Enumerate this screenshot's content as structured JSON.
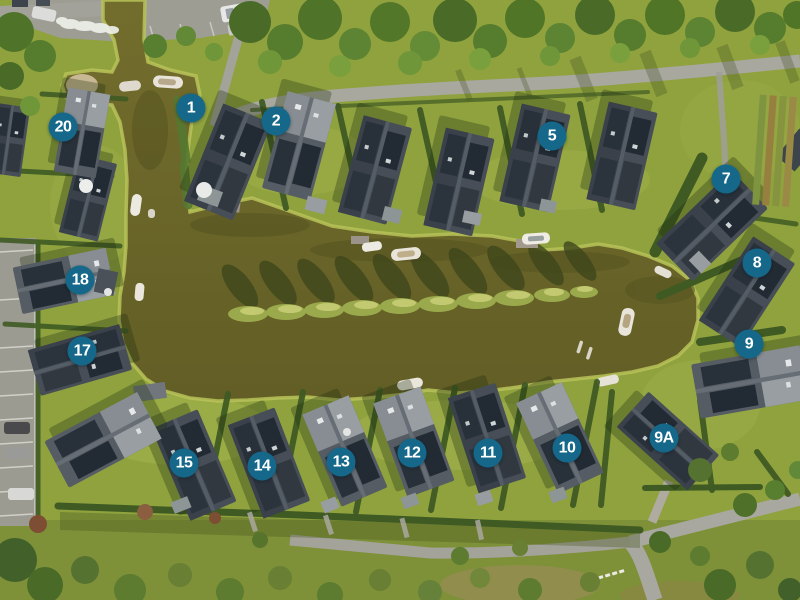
{
  "park_map": {
    "description": "aerial-photo-site-map-with-numbered-lots",
    "marker_color": "#15688a",
    "marker_text_color": "#ffffff",
    "markers": [
      {
        "label": "1",
        "x": 191,
        "y": 108
      },
      {
        "label": "2",
        "x": 276,
        "y": 121
      },
      {
        "label": "5",
        "x": 552,
        "y": 136
      },
      {
        "label": "7",
        "x": 726,
        "y": 179
      },
      {
        "label": "8",
        "x": 757,
        "y": 263
      },
      {
        "label": "9",
        "x": 749,
        "y": 344
      },
      {
        "label": "9A",
        "x": 664,
        "y": 438
      },
      {
        "label": "10",
        "x": 567,
        "y": 448
      },
      {
        "label": "11",
        "x": 488,
        "y": 453
      },
      {
        "label": "12",
        "x": 412,
        "y": 453
      },
      {
        "label": "13",
        "x": 341,
        "y": 462
      },
      {
        "label": "14",
        "x": 262,
        "y": 466
      },
      {
        "label": "15",
        "x": 184,
        "y": 463
      },
      {
        "label": "17",
        "x": 82,
        "y": 351
      },
      {
        "label": "18",
        "x": 80,
        "y": 280
      },
      {
        "label": "20",
        "x": 63,
        "y": 127
      }
    ],
    "colors": {
      "grass": "#8fa23e",
      "water": "#6e682a",
      "roof_dark": "#3c434b",
      "hedge": "#3f5a23",
      "road": "#a8a89e"
    }
  }
}
